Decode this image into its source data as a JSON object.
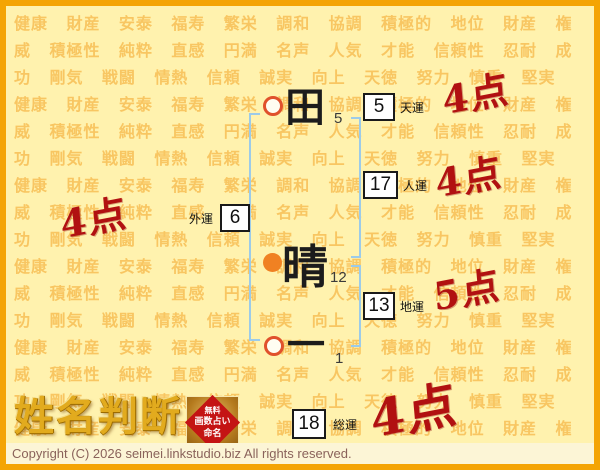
{
  "background": {
    "words": [
      "健康",
      "財産",
      "安泰",
      "福寿",
      "繁栄",
      "調和",
      "協調",
      "積極的",
      "地位",
      "財産",
      "権威",
      "積極性",
      "純粋",
      "直感",
      "円満",
      "名声",
      "人気",
      "才能",
      "信頼性",
      "忍耐",
      "成功",
      "剛気",
      "戦闘",
      "情熱",
      "信頼",
      "誠実",
      "向上",
      "天徳",
      "努力",
      "慎重",
      "堅実"
    ],
    "repeat": 7
  },
  "chart": {
    "characters": [
      {
        "char": "田",
        "strokes": "5",
        "marker": "ring"
      },
      {
        "char": "晴",
        "strokes": "12",
        "marker": "dot"
      },
      {
        "char": "一",
        "strokes": "1",
        "marker": "ring"
      }
    ],
    "fortunes": [
      {
        "id": "tenun",
        "label": "天運",
        "value": "5"
      },
      {
        "id": "jinun",
        "label": "人運",
        "value": "17"
      },
      {
        "id": "gaiun",
        "label": "外運",
        "value": "6"
      },
      {
        "id": "chiun",
        "label": "地運",
        "value": "13"
      },
      {
        "id": "souun",
        "label": "総運",
        "value": "18"
      }
    ],
    "scores": {
      "tenun": "4点",
      "jinun": "4点",
      "gaiun": "4点",
      "chiun": "5点",
      "souun": "4点"
    }
  },
  "logo": {
    "title": "姓名判断",
    "stamp_lines": [
      "無料",
      "画数占い",
      "命名"
    ]
  },
  "footer": {
    "copyright": "Copyright (C) 2026 seimei.linkstudio.biz All rights reserved."
  },
  "colors": {
    "border": "#f4a404",
    "page_bg": "#fff2ae",
    "watermark": "#f2a324",
    "bracket_blue": "#9ccbe9",
    "score_red": "#b11111",
    "marker_ring": "#e0512c",
    "marker_dot": "#f08122",
    "stamp_red": "#c41414",
    "logo_gold": "#e2ab1e"
  }
}
